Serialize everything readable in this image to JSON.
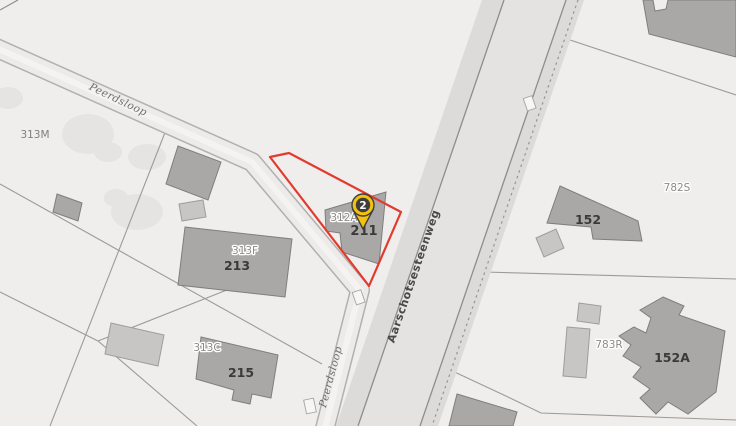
{
  "map": {
    "roads": {
      "peerdsloop_upper": "Peerdsloop",
      "peerdsloop_lower": "Peerdsloop",
      "main_road": "Aarschotsesteenweg"
    },
    "parcels": {
      "p313M": "313M",
      "p313F": "313F",
      "p213": "213",
      "p313C": "313C",
      "p215": "215",
      "p312A": "312A",
      "p211": "211",
      "p152": "152",
      "p782S": "782S",
      "p783R": "783R",
      "p152A": "152A"
    },
    "marker": {
      "label": "2",
      "color": "#f2c20f",
      "ring_color": "#3f3e3d"
    },
    "selection": {
      "outline_color": "#e23b2e"
    },
    "colors": {
      "background": "#efeeed",
      "road": "#dcdbda",
      "building_dark": "#a9a8a6",
      "building_light": "#c7c6c4",
      "boundary_line": "#9c9b9a"
    }
  }
}
